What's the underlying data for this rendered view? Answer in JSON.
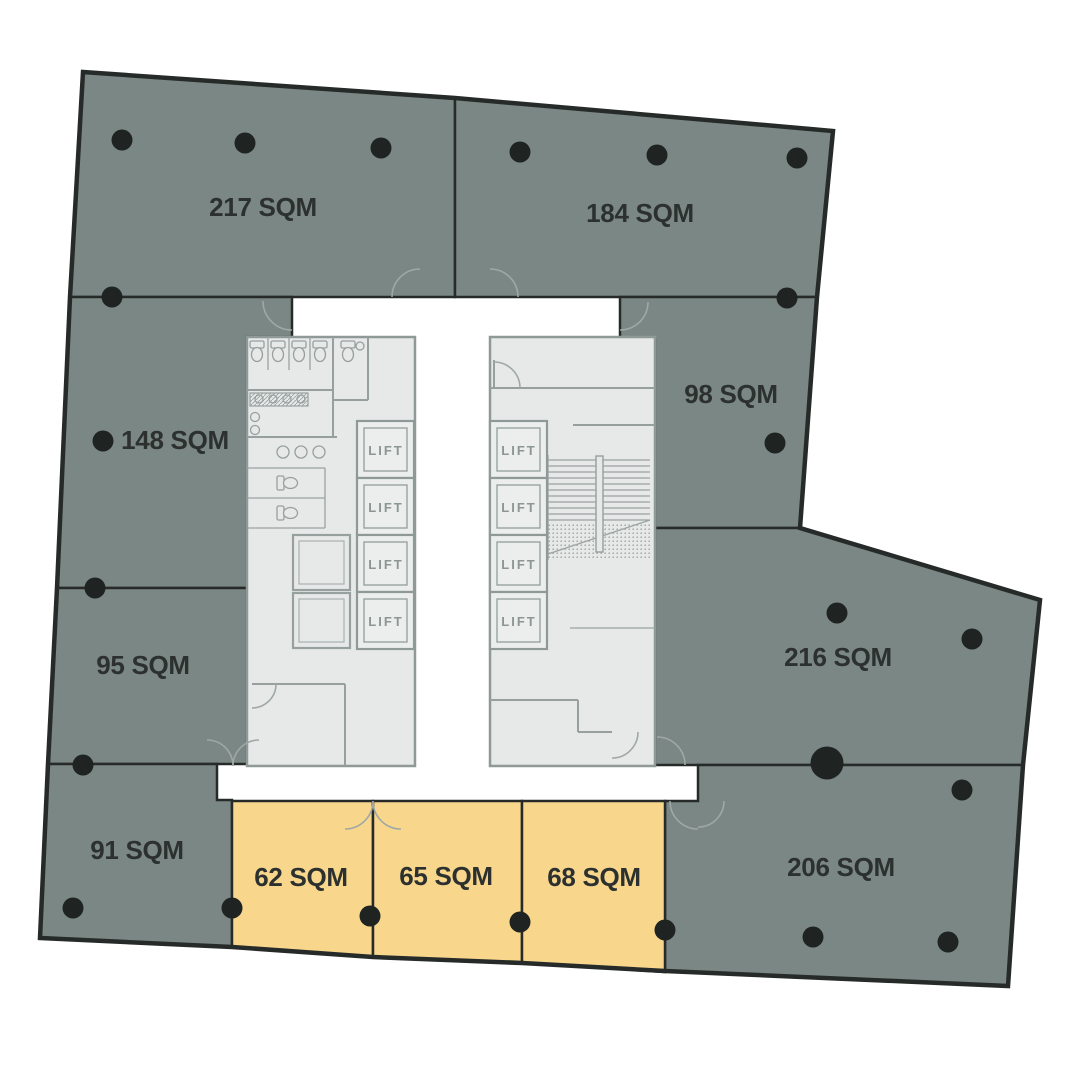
{
  "plan": {
    "core": {
      "lift_label": "LIFT",
      "lift_count": 8
    },
    "units": [
      {
        "id": "217",
        "label": "217 SQM",
        "area_sqm": 217,
        "highlighted": false
      },
      {
        "id": "184",
        "label": "184 SQM",
        "area_sqm": 184,
        "highlighted": false
      },
      {
        "id": "148",
        "label": "148 SQM",
        "area_sqm": 148,
        "highlighted": false
      },
      {
        "id": "98",
        "label": "98 SQM",
        "area_sqm": 98,
        "highlighted": false
      },
      {
        "id": "95",
        "label": "95 SQM",
        "area_sqm": 95,
        "highlighted": false
      },
      {
        "id": "216",
        "label": "216 SQM",
        "area_sqm": 216,
        "highlighted": false
      },
      {
        "id": "91",
        "label": "91 SQM",
        "area_sqm": 91,
        "highlighted": false
      },
      {
        "id": "206",
        "label": "206 SQM",
        "area_sqm": 206,
        "highlighted": false
      },
      {
        "id": "62",
        "label": "62 SQM",
        "area_sqm": 62,
        "highlighted": true
      },
      {
        "id": "65",
        "label": "65 SQM",
        "area_sqm": 65,
        "highlighted": true
      },
      {
        "id": "68",
        "label": "68 SQM",
        "area_sqm": 68,
        "highlighted": true
      }
    ],
    "colors": {
      "unit_fill": "#7B8784",
      "highlight_fill": "#F8D78D",
      "outline": "#262B29",
      "core_fill": "#E6E9E8",
      "core_line": "#97A09E",
      "column_dot": "#1F2422",
      "label_text": "#2C312F"
    }
  }
}
